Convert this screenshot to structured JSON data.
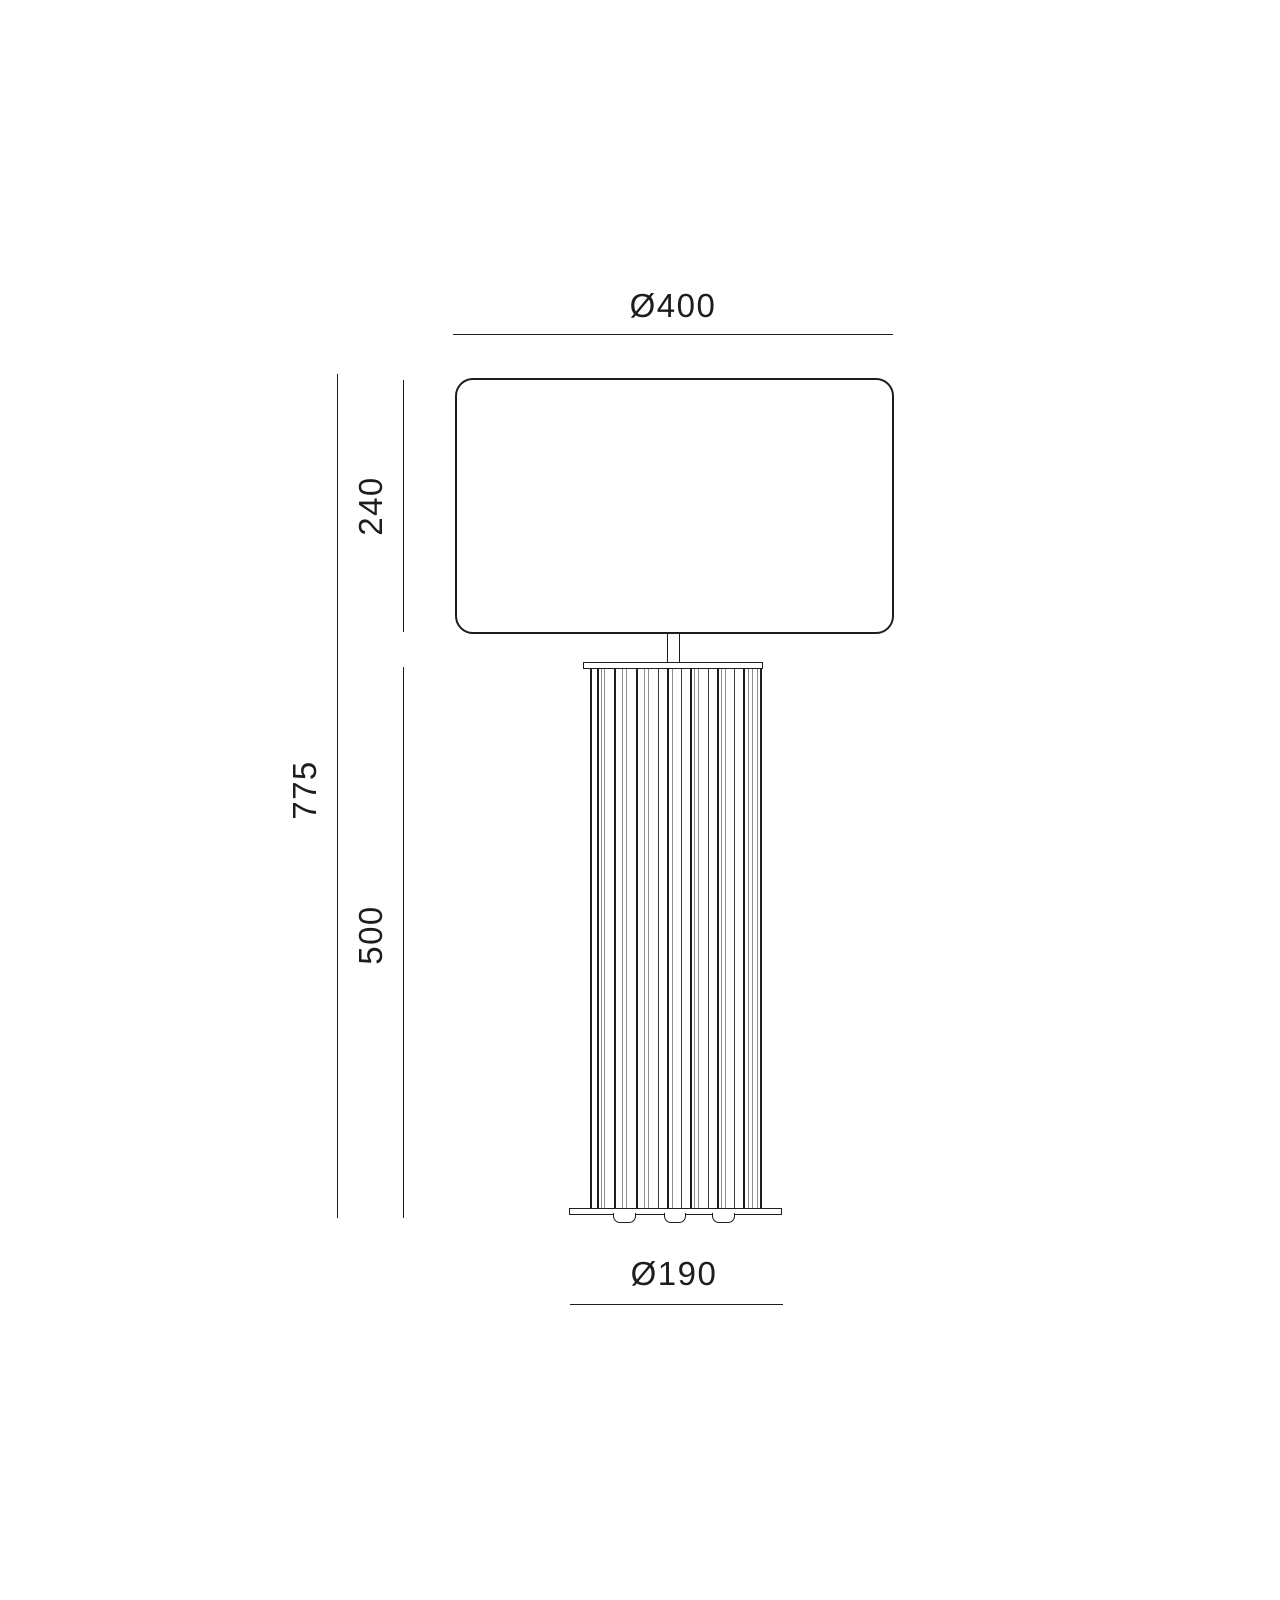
{
  "document": {
    "background_color": "#ffffff",
    "line_color": "#1d1d1b",
    "subject": "table lamp dimension drawing"
  },
  "dimensions": {
    "shade_diameter": {
      "label": "Ø400"
    },
    "shade_height": {
      "label": "240"
    },
    "total_height": {
      "label": "775"
    },
    "column_height": {
      "label": "500"
    },
    "base_diameter": {
      "label": "Ø190"
    }
  },
  "drawing": {
    "parts": [
      "shade",
      "stem",
      "top-cap",
      "fluted-column",
      "base-plate",
      "feet"
    ],
    "feet_count": 3,
    "column_rods": [
      {
        "p": 0,
        "t": "d"
      },
      {
        "p": 4,
        "t": "d"
      },
      {
        "p": 6.5,
        "t": "l"
      },
      {
        "p": 8.5,
        "t": "l"
      },
      {
        "p": 14,
        "t": "d"
      },
      {
        "p": 19,
        "t": "l"
      },
      {
        "p": 21.2,
        "t": "l"
      },
      {
        "p": 27,
        "t": "d"
      },
      {
        "p": 31.8,
        "t": "l"
      },
      {
        "p": 34,
        "t": "l"
      },
      {
        "p": 40,
        "t": "m"
      },
      {
        "p": 45.3,
        "t": "d"
      },
      {
        "p": 48.2,
        "t": "l"
      },
      {
        "p": 53.5,
        "t": "m"
      },
      {
        "p": 58.8,
        "t": "d"
      },
      {
        "p": 61.2,
        "t": "l"
      },
      {
        "p": 63.5,
        "t": "l"
      },
      {
        "p": 69.4,
        "t": "m"
      },
      {
        "p": 74.7,
        "t": "d"
      },
      {
        "p": 77.1,
        "t": "l"
      },
      {
        "p": 79.4,
        "t": "l"
      },
      {
        "p": 84.7,
        "t": "m"
      },
      {
        "p": 90,
        "t": "d"
      },
      {
        "p": 92.9,
        "t": "l"
      },
      {
        "p": 95.3,
        "t": "l"
      },
      {
        "p": 98,
        "t": "l"
      },
      {
        "p": 100,
        "t": "d"
      }
    ]
  }
}
